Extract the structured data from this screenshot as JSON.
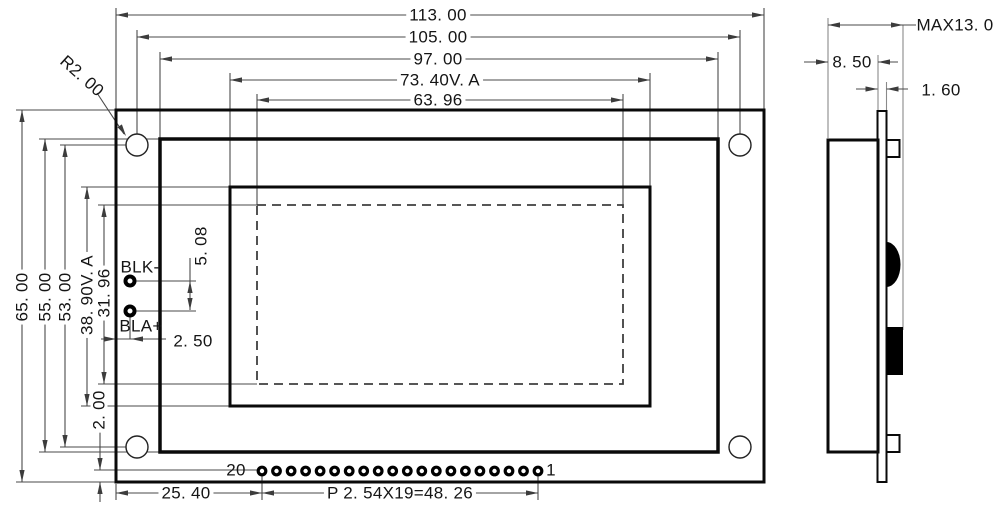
{
  "drawing": {
    "front_view": {
      "dims_horizontal": {
        "board_width": "113. 00",
        "hole_spacing": "105. 00",
        "bezel_width": "97. 00",
        "viewing_area_width": "73. 40V. A",
        "active_area_width": "63. 96"
      },
      "dims_vertical": {
        "board_height": "65. 00",
        "bezel_height": "55. 00",
        "hole_spacing": "53. 00",
        "viewing_area_height": "38. 90V. A",
        "active_area_height": "31. 96",
        "pin_row_offset": "2. 00"
      },
      "corner_radius": "R2. 00",
      "backlight_pads": {
        "negative_label": "BLK-",
        "positive_label": "BLA+",
        "pad_pitch": "5. 08",
        "edge_offset": "2. 50"
      },
      "pin_row": {
        "first_pin": "20",
        "last_pin": "1",
        "left_offset": "25. 40",
        "pitch_formula": "P 2. 54X19=48. 26"
      }
    },
    "side_view": {
      "max_thickness": "MAX13. 0",
      "body_depth": "8. 50",
      "pcb_thickness": "1. 60"
    }
  }
}
